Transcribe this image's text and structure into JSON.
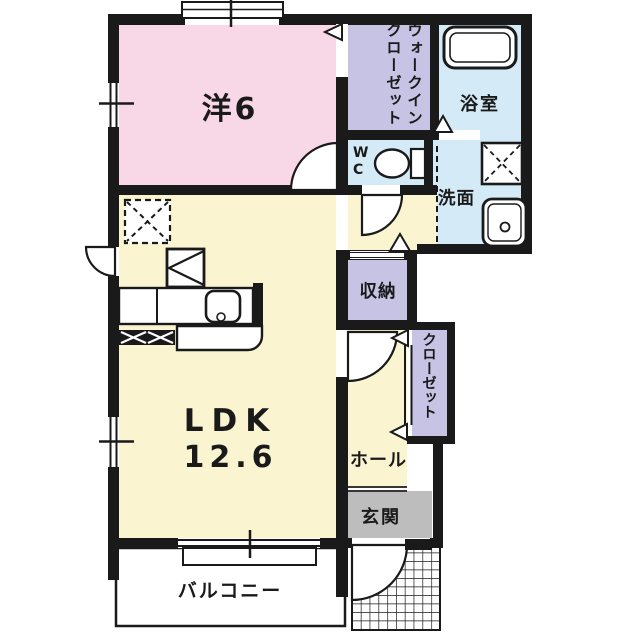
{
  "plan_type": "apartment-floor-plan",
  "rooms": {
    "western": {
      "label": "洋6"
    },
    "ldk": {
      "line1": "LDK",
      "line2": "12.6"
    },
    "wic": {
      "label": "ウォークインクローゼット"
    },
    "bath": {
      "label": "浴室"
    },
    "wc": {
      "label": "WC"
    },
    "washroom": {
      "label": "洗面"
    },
    "storage": {
      "label": "収納"
    },
    "closet": {
      "label": "クローゼット"
    },
    "hall": {
      "label": "ホール"
    },
    "entrance": {
      "label": "玄関"
    },
    "balcony": {
      "label": "バルコニー"
    }
  },
  "colors": {
    "wall": "#1a1a1a",
    "western_room": "#f8d7e7",
    "ldk": "#fbf4d0",
    "closet_purple": "#c7c3e5",
    "wet_blue": "#d4eaf6",
    "entrance_gray": "#bdbdbd",
    "paper": "#ffffff"
  },
  "fixtures": [
    "bathtub-icon",
    "toilet-icon",
    "vanity-sink-icon",
    "washer-space-icon",
    "kitchen-counter-icon",
    "kitchen-sink-icon",
    "refrigerator-space-icon",
    "range-space-icon",
    "door-swing-arc",
    "window-symbol",
    "porch-tile-grid",
    "shoe-cabinet",
    "door-triangle-marker"
  ]
}
